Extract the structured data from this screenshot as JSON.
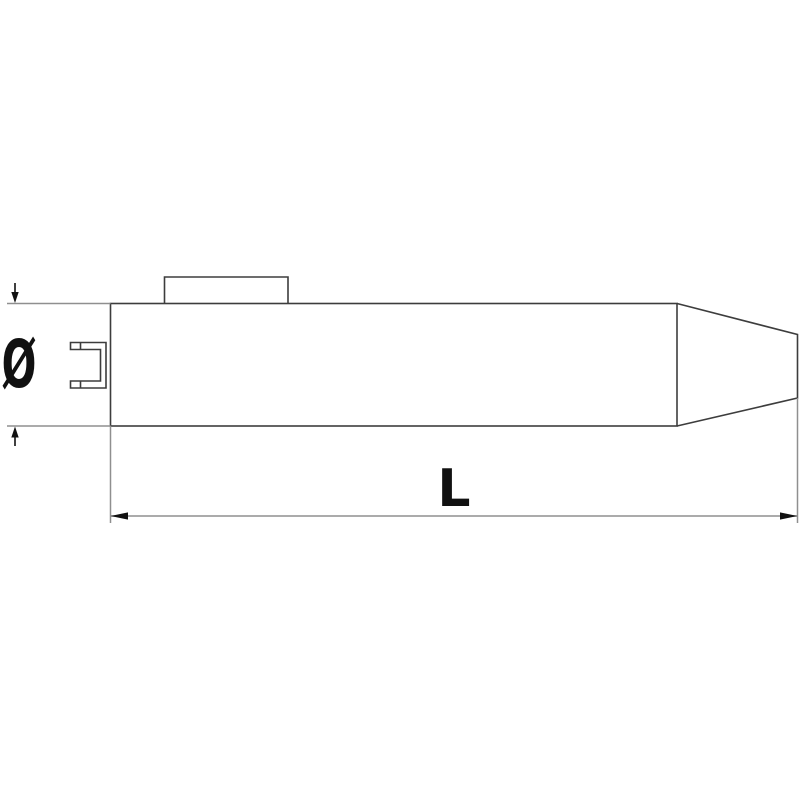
{
  "drawing": {
    "labels": {
      "diameter": "Ø",
      "length": "L"
    },
    "colors": {
      "background": "#ffffff",
      "outline": "#3d3d3d",
      "dimension": "#8f8f8f",
      "annotation": "#111111"
    }
  }
}
